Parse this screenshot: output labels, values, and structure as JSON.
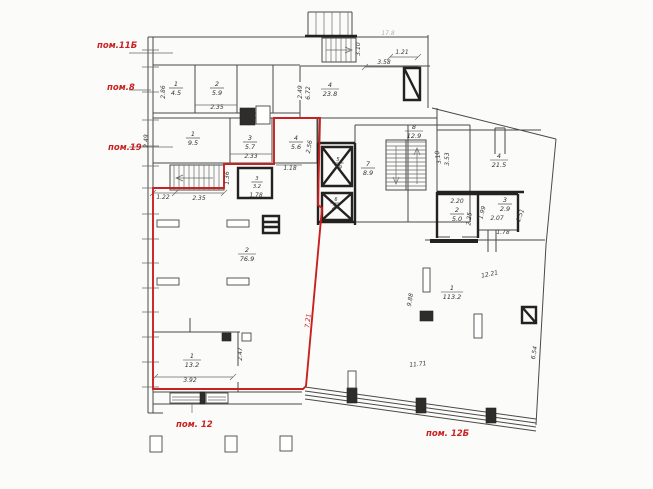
{
  "plan": {
    "title": "floor-plan-drawing",
    "colors": {
      "boundary_red": "#c92121",
      "wall_ink": "#34332f",
      "paper": "#fbfbfa"
    },
    "red_labels": [
      {
        "t": "пом.11Б",
        "x": 97,
        "y": 48
      },
      {
        "t": "пом.8",
        "x": 107,
        "y": 90
      },
      {
        "t": "пом.19",
        "x": 108,
        "y": 150
      },
      {
        "t": "пом. 12",
        "x": 176,
        "y": 427
      },
      {
        "t": "пом. 12Б",
        "x": 426,
        "y": 436
      }
    ],
    "rooms": [
      {
        "n": "1",
        "a": "4.5",
        "x": 176,
        "y": 86
      },
      {
        "n": "2",
        "a": "5.9",
        "x": 217,
        "y": 86
      },
      {
        "n": "1",
        "a": "9.5",
        "x": 193,
        "y": 136
      },
      {
        "n": "3",
        "a": "5.7",
        "x": 250,
        "y": 140
      },
      {
        "n": "4",
        "a": "5.6",
        "x": 296,
        "y": 140
      },
      {
        "n": "3",
        "a": "3.2",
        "x": 257,
        "y": 180,
        "s": true
      },
      {
        "n": "4",
        "a": "23.8",
        "x": 330,
        "y": 87
      },
      {
        "n": "7",
        "a": "8.9",
        "x": 368,
        "y": 166
      },
      {
        "n": "8",
        "a": "12.9",
        "x": 414,
        "y": 129
      },
      {
        "n": "5",
        "a": "2.9",
        "x": 338,
        "y": 161,
        "s": true
      },
      {
        "n": "6",
        "a": "2.6",
        "x": 336,
        "y": 201,
        "s": true
      },
      {
        "n": "2",
        "a": "76.9",
        "x": 247,
        "y": 252
      },
      {
        "n": "4",
        "a": "21.5",
        "x": 499,
        "y": 158
      },
      {
        "n": "2",
        "a": "5.0",
        "x": 457,
        "y": 212
      },
      {
        "n": "3",
        "a": "2.9",
        "x": 505,
        "y": 202
      },
      {
        "n": "1",
        "a": "113.2",
        "x": 452,
        "y": 290
      },
      {
        "n": "1",
        "a": "13.2",
        "x": 192,
        "y": 358
      }
    ],
    "dims": [
      {
        "t": "2.86",
        "x": 165,
        "y": 92,
        "r": -90
      },
      {
        "t": "2.35",
        "x": 217,
        "y": 109
      },
      {
        "t": "2.49",
        "x": 148,
        "y": 141,
        "r": -90
      },
      {
        "t": "2.33",
        "x": 251,
        "y": 158
      },
      {
        "t": "2.56",
        "x": 311,
        "y": 147,
        "r": -80
      },
      {
        "t": "1.18",
        "x": 290,
        "y": 170
      },
      {
        "t": "1.78",
        "x": 256,
        "y": 197
      },
      {
        "t": "1.22",
        "x": 163,
        "y": 199
      },
      {
        "t": "2.35",
        "x": 199,
        "y": 200
      },
      {
        "t": "1.36",
        "x": 229,
        "y": 178,
        "r": -90
      },
      {
        "t": "2.49",
        "x": 302,
        "y": 92,
        "r": -90
      },
      {
        "t": "6.72",
        "x": 310,
        "y": 93,
        "r": -90
      },
      {
        "t": "3.10",
        "x": 360,
        "y": 49,
        "r": -90
      },
      {
        "t": "1.21",
        "x": 402,
        "y": 54
      },
      {
        "t": "3.58",
        "x": 384,
        "y": 64
      },
      {
        "t": "17.8",
        "x": 388,
        "y": 35,
        "f": true
      },
      {
        "t": "3.10",
        "x": 440,
        "y": 157,
        "r": -100
      },
      {
        "t": "3.53",
        "x": 449,
        "y": 159,
        "r": -90
      },
      {
        "t": "2.20",
        "x": 457,
        "y": 203
      },
      {
        "t": "2.25",
        "x": 471,
        "y": 219,
        "r": -85
      },
      {
        "t": "1.99",
        "x": 484,
        "y": 213,
        "r": -75
      },
      {
        "t": "2.07",
        "x": 497,
        "y": 220
      },
      {
        "t": "1.78",
        "x": 503,
        "y": 234
      },
      {
        "t": "1.51",
        "x": 522,
        "y": 216,
        "r": -70
      },
      {
        "t": "12.21",
        "x": 490,
        "y": 276,
        "r": -12
      },
      {
        "t": "9.88",
        "x": 412,
        "y": 300,
        "r": -80
      },
      {
        "t": "11.71",
        "x": 418,
        "y": 366,
        "r": -6
      },
      {
        "t": "6.54",
        "x": 536,
        "y": 353,
        "r": -80
      },
      {
        "t": "2.47",
        "x": 242,
        "y": 354,
        "r": -90
      },
      {
        "t": "3.92",
        "x": 190,
        "y": 382
      }
    ],
    "red_dim": {
      "t": "7.21",
      "x": 310,
      "y": 321,
      "r": -84
    }
  }
}
